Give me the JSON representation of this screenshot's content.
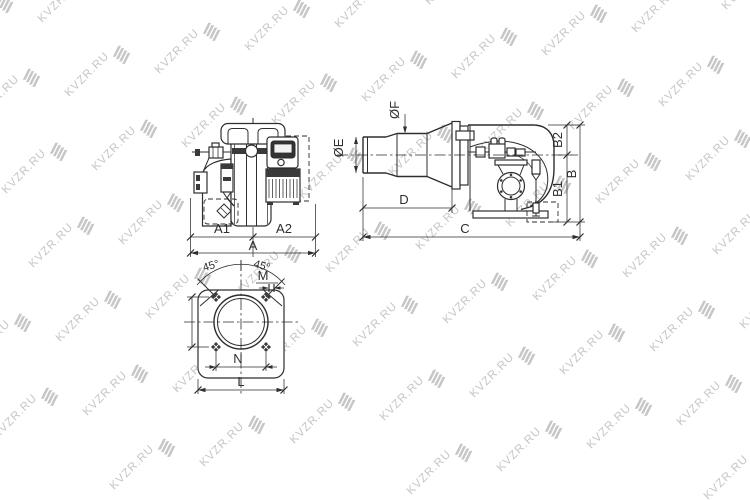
{
  "watermark": {
    "text": "KVZR.RU"
  },
  "labels": {
    "a1": "A1",
    "a2": "A2",
    "a": "A",
    "oe": "ØE",
    "of": "ØF",
    "d": "D",
    "c": "C",
    "b2": "B2",
    "b1": "B1",
    "b": "B",
    "angle_left": "45°",
    "angle_right": "45°",
    "m": "M",
    "n": "N",
    "l": "L"
  },
  "colors": {
    "line": "#2e2e2e",
    "watermark": "#c6c6c6",
    "background": "#ffffff"
  }
}
